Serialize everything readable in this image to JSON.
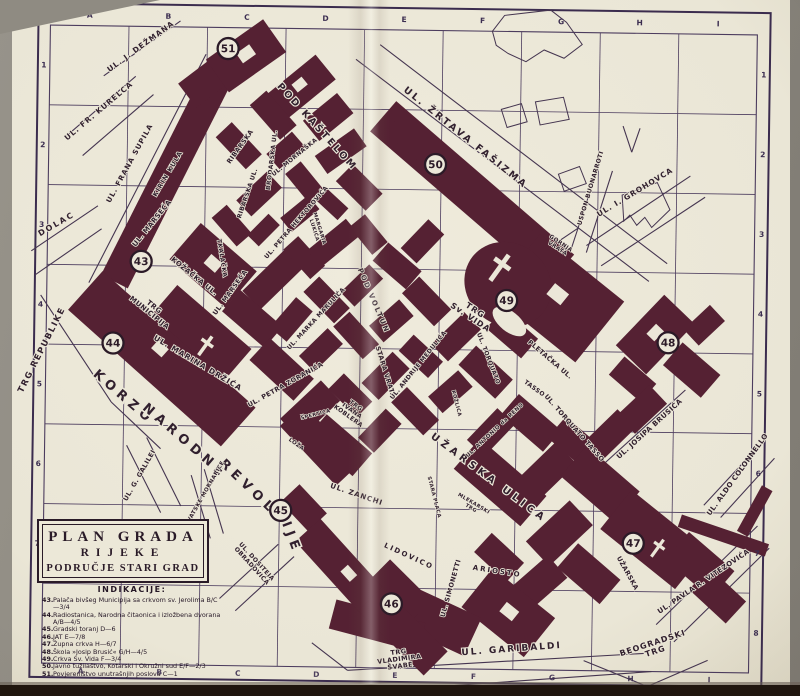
{
  "legend_box": {
    "line1": "PLAN GRADA",
    "line2": "RIJEKE",
    "line3": "PODRUČJE STARI GRAD"
  },
  "indications": {
    "heading": "INDIKACIJE:",
    "items": [
      {
        "n": "43.",
        "t": "Palača bivšeg Municipija sa crkvom sv. Jerolima B/C—3/4"
      },
      {
        "n": "44.",
        "t": "Radiostanica, Narodna čitaonica i izložbena dvorana A/B—4/5"
      },
      {
        "n": "45.",
        "t": "Gradski toranj D—6"
      },
      {
        "n": "46.",
        "t": "JAT E—7/8"
      },
      {
        "n": "47.",
        "t": "Župna crkva H—6/7"
      },
      {
        "n": "48.",
        "t": "Škola »Josip Brusić« G/H—4/5"
      },
      {
        "n": "49.",
        "t": "Crkva Sv. Vida F—3/4"
      },
      {
        "n": "50.",
        "t": "Javno tužilaštvo, Kotarski i Okružni sud E/F—2/3"
      },
      {
        "n": "51.",
        "t": "Povjereništvo unutrašnjih poslova C—1"
      }
    ]
  },
  "map": {
    "grid": {
      "column_letters": [
        "A",
        "B",
        "C",
        "D",
        "E",
        "F",
        "G",
        "H",
        "I"
      ],
      "left_row_numbers": [
        "1",
        "2",
        "3",
        "4",
        "5",
        "6",
        "7"
      ],
      "right_row_numbers": [
        "1",
        "2",
        "3",
        "4",
        "5",
        "6",
        "7",
        "8"
      ]
    },
    "markers": [
      {
        "n": "43",
        "x": 140,
        "y": 265
      },
      {
        "n": "44",
        "x": 113,
        "y": 347
      },
      {
        "n": "45",
        "x": 283,
        "y": 512
      },
      {
        "n": "46",
        "x": 395,
        "y": 604
      },
      {
        "n": "47",
        "x": 636,
        "y": 540
      },
      {
        "n": "48",
        "x": 668,
        "y": 339
      },
      {
        "n": "49",
        "x": 506,
        "y": 299
      },
      {
        "n": "50",
        "x": 433,
        "y": 164
      },
      {
        "n": "51",
        "x": 224,
        "y": 51
      }
    ],
    "streets": [
      {
        "t": "UL. J. DEŽMANA",
        "x": 138,
        "y": 52,
        "r": -37,
        "s": 7.5,
        "sp": 1
      },
      {
        "t": "UL. FR. KURELCA",
        "x": 97,
        "y": 117,
        "r": -41,
        "s": 7.5,
        "sp": 1
      },
      {
        "t": "UL. FRANA SUPILA",
        "x": 129,
        "y": 168,
        "r": -62,
        "s": 7,
        "sp": 1
      },
      {
        "t": "DOLAC",
        "x": 56,
        "y": 231,
        "r": -31,
        "s": 8,
        "sp": 2
      },
      {
        "t": "TRG REPUBLIKE",
        "x": 44,
        "y": 356,
        "r": -64,
        "s": 8.5,
        "sp": 1.5
      },
      {
        "t": "KIRIN KULA",
        "x": 167,
        "y": 178,
        "r": -60,
        "s": 6.5,
        "sp": 1
      },
      {
        "t": "UL. MARSEĆA",
        "x": 152,
        "y": 228,
        "r": -52,
        "s": 7
      },
      {
        "t": "UL. MARSEĆA",
        "x": 231,
        "y": 296,
        "r": -55,
        "s": 6.5
      },
      {
        "t": "RIBARSKA",
        "x": 239,
        "y": 150,
        "r": -55,
        "s": 6.5
      },
      {
        "t": "RIBARSKA UL.",
        "x": 247,
        "y": 196,
        "r": -72,
        "s": 6
      },
      {
        "t": "BRODARSKA UL.",
        "x": 271,
        "y": 162,
        "r": -84,
        "s": 6
      },
      {
        "t": "UL. MORNAŠKA",
        "x": 293,
        "y": 160,
        "r": -40,
        "s": 6
      },
      {
        "t": "POD KAŠTELOM",
        "x": 312,
        "y": 130,
        "r": 47,
        "s": 9.5,
        "sp": 2.5
      },
      {
        "t": "UL. ŽRTAVA FAŠIZMA",
        "x": 461,
        "y": 139,
        "r": 38,
        "s": 9.5,
        "sp": 2.5
      },
      {
        "t": "USPON BUONARROTI",
        "x": 590,
        "y": 186,
        "r": -74,
        "s": 6
      },
      {
        "t": "UL. I. GROHOVCA",
        "x": 634,
        "y": 191,
        "r": -32,
        "s": 7.5,
        "sp": 1
      },
      {
        "lines": [
          "GORNJA",
          "VRATA"
        ],
        "x": 557,
        "y": 245,
        "r": 33,
        "s": 5.5
      },
      {
        "lines": [
          "TRG",
          "Sv. VIDA"
        ],
        "x": 471,
        "y": 315,
        "r": 33,
        "s": 8,
        "sp": 1
      },
      {
        "t": "UL. TORQUATO",
        "x": 487,
        "y": 358,
        "r": 68,
        "s": 6
      },
      {
        "t": "TASSO",
        "x": 534,
        "y": 388,
        "r": 35,
        "s": 6
      },
      {
        "t": "UL. TORQUATO TASSO",
        "x": 574,
        "y": 427,
        "r": 48,
        "s": 6.5
      },
      {
        "t": "PLETAČKA UL.",
        "x": 549,
        "y": 359,
        "r": 40,
        "s": 6.5
      },
      {
        "t": "UL. JOSIPA BRUSIĆA",
        "x": 652,
        "y": 427,
        "r": -43,
        "s": 7
      },
      {
        "t": "UŽARSKA ULICA",
        "x": 489,
        "y": 479,
        "r": 36,
        "s": 10,
        "sp": 4
      },
      {
        "t": "UL. ANTONIO da RENO",
        "x": 497,
        "y": 430,
        "r": -44,
        "s": 5.5
      },
      {
        "t": "UL. ZANCHI",
        "x": 358,
        "y": 497,
        "r": 18,
        "s": 7,
        "sp": 1
      },
      {
        "t": "LIDOVICO",
        "x": 411,
        "y": 558,
        "r": 24,
        "s": 7,
        "sp": 2
      },
      {
        "t": "ARIOSTO",
        "x": 500,
        "y": 572,
        "r": 8,
        "s": 7,
        "sp": 2
      },
      {
        "t": "UL. SIMONETTI",
        "x": 456,
        "y": 588,
        "r": -75,
        "s": 6.5
      },
      {
        "lines": [
          "MLEKARSKI",
          "TRG"
        ],
        "x": 474,
        "y": 506,
        "r": 30,
        "s": 5
      },
      {
        "t": "KORZO",
        "x": 122,
        "y": 404,
        "r": 40,
        "s": 13,
        "sp": 5
      },
      {
        "t": "NARODNE",
        "x": 184,
        "y": 447,
        "r": 40,
        "s": 13,
        "sp": 5
      },
      {
        "t": "REVOLU",
        "x": 253,
        "y": 497,
        "r": 43,
        "s": 13,
        "sp": 5
      },
      {
        "t": "CIJE",
        "x": 288,
        "y": 534,
        "r": 68,
        "s": 13,
        "sp": 5
      },
      {
        "t": "UL. G. GALILEI",
        "x": 143,
        "y": 480,
        "r": -61,
        "s": 6.5
      },
      {
        "t": "TRG HRVATSKE MORNARICE",
        "x": 203,
        "y": 506,
        "r": -61,
        "s": 5.5
      },
      {
        "lines": [
          "UL. DOSITEJA",
          "OBRADOVIĆA"
        ],
        "x": 256,
        "y": 567,
        "r": 47,
        "s": 6
      },
      {
        "lines": [
          "TRG",
          "VLADIMIRA",
          "ŠVABE"
        ],
        "x": 404,
        "y": 661,
        "r": -8,
        "s": 6.5
      },
      {
        "t": "UL. GARIBALDI",
        "x": 516,
        "y": 650,
        "r": -5,
        "s": 9,
        "sp": 2
      },
      {
        "lines": [
          "BEOGRADSKI",
          "TRG"
        ],
        "x": 659,
        "y": 646,
        "r": -19,
        "s": 8,
        "sp": 1
      },
      {
        "t": "UL. PAVLA R. VITEZOVIĆA",
        "x": 708,
        "y": 579,
        "r": -35,
        "s": 7
      },
      {
        "t": "UL. ALDO COLONNELLO",
        "x": 741,
        "y": 471,
        "r": -55,
        "s": 7
      },
      {
        "t": "UŽARSKA",
        "x": 629,
        "y": 571,
        "r": 60,
        "s": 6.5
      },
      {
        "lines": [
          "TRG",
          "MUNICIPIJA"
        ],
        "x": 150,
        "y": 315,
        "r": 38,
        "s": 7
      },
      {
        "t": "KOŽAČKA UL.",
        "x": 192,
        "y": 281,
        "r": 38,
        "s": 7
      },
      {
        "t": "TKALAČKA",
        "x": 219,
        "y": 261,
        "r": 80,
        "s": 6
      },
      {
        "t": "UL. PETRA HEKTOROVIĆA",
        "x": 296,
        "y": 225,
        "r": -50,
        "s": 6
      },
      {
        "lines": [
          "MARGARIA",
          "LUKIĆA"
        ],
        "x": 314,
        "y": 231,
        "r": 72,
        "s": 5
      },
      {
        "t": "POD VOLTUN",
        "x": 371,
        "y": 302,
        "r": 66,
        "s": 7,
        "sp": 2
      },
      {
        "t": "STARA VRATA",
        "x": 384,
        "y": 373,
        "r": 72,
        "s": 6.5
      },
      {
        "t": "UL. MARKA MARULIĆA",
        "x": 317,
        "y": 321,
        "r": -48,
        "s": 6
      },
      {
        "t": "UL. PETRA ZORANIĆA",
        "x": 287,
        "y": 388,
        "r": -30,
        "s": 6.5
      },
      {
        "t": "UL. MARINA DRŽIĆA",
        "x": 197,
        "y": 368,
        "r": 30,
        "s": 7.5,
        "sp": 1
      },
      {
        "lines": [
          "TRG",
          "IVANA",
          "KOBLERA"
        ],
        "x": 352,
        "y": 413,
        "r": 35,
        "s": 6
      },
      {
        "t": "LOŽA",
        "x": 297,
        "y": 447,
        "r": 35,
        "s": 5.5
      },
      {
        "t": "UL. ANDRIJE MEDULIĆA",
        "x": 420,
        "y": 366,
        "r": -52,
        "s": 6
      },
      {
        "t": "ŠPERTICA",
        "x": 317,
        "y": 417,
        "r": -15,
        "s": 5
      },
      {
        "t": "STARA PLACA",
        "x": 435,
        "y": 497,
        "r": 75,
        "s": 5
      },
      {
        "t": "KOŽLICA",
        "x": 456,
        "y": 403,
        "r": 75,
        "s": 5
      }
    ]
  }
}
